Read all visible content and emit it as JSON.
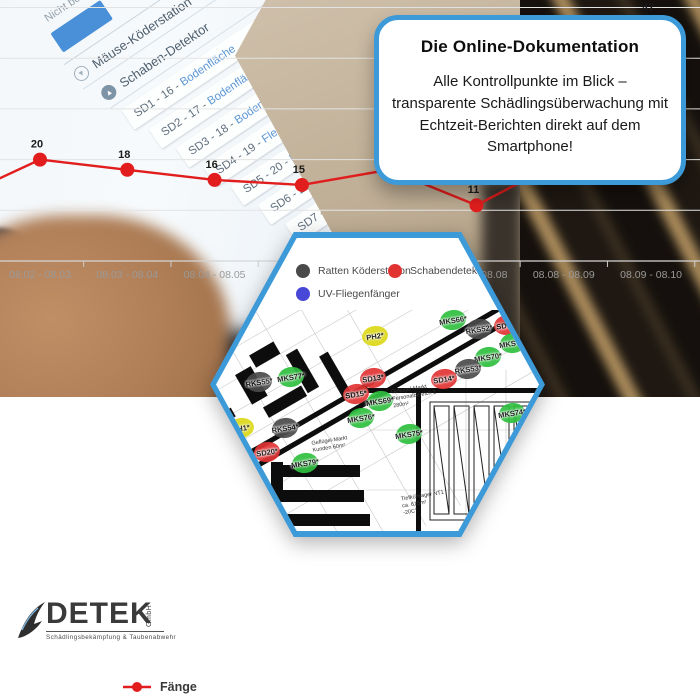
{
  "infobox": {
    "title": "Die Online-Dokumentation",
    "body": "Alle Kontrollpunkte im Blick – transparente Schädlingsüberwachung mit Echtzeit-Berichten direkt auf dem Smartphone!"
  },
  "phone": {
    "top_label": "Neu",
    "status_label": "Nicht besucht",
    "sections": [
      {
        "label": "Mäuse-Köderstation"
      },
      {
        "label": "Schaben-Detektor"
      }
    ],
    "items": [
      {
        "code": "SD1 - 16 - ",
        "location": "Bodenfläche"
      },
      {
        "code": "SD2 - 17 - ",
        "location": "Bodenfläche"
      },
      {
        "code": "SD3 - 18 - ",
        "location": "Bodenfläche"
      },
      {
        "code": "SD4 - 19 - ",
        "location": "Fleischerei"
      },
      {
        "code": "SD5 - 20 - ",
        "location": "Fleischerei"
      },
      {
        "code": "SD6 - 21 - ",
        "location": "Lager"
      },
      {
        "code": "SD7 - 22 - ",
        "location": "Lager"
      },
      {
        "code": "SD8 - 23 - ",
        "location": "Lager"
      }
    ]
  },
  "hexagon": {
    "legend": [
      {
        "label": "Mäuse Köderstation",
        "color": "#2fbf3f",
        "clipped": true,
        "x": -4,
        "y": 26
      },
      {
        "label": "Ratten Köderstation",
        "color": "#4a4a4a",
        "clipped": false,
        "x": 80,
        "y": 26
      },
      {
        "label": "Schabendetektor",
        "color": "#e23333",
        "clipped": false,
        "x": 172,
        "y": 26
      },
      {
        "label": "Pheromonfalle",
        "color": "#ddd818",
        "clipped": true,
        "x": -4,
        "y": 49
      },
      {
        "label": "UV-Fliegenfänger",
        "color": "#4747d8",
        "clipped": false,
        "x": 80,
        "y": 49
      }
    ],
    "markers": [
      {
        "id": "PH2*",
        "type": "ph",
        "x": 146,
        "y": 88
      },
      {
        "id": "MKS66*",
        "type": "mks",
        "x": 224,
        "y": 72
      },
      {
        "id": "RKS52*",
        "type": "rks",
        "x": 250,
        "y": 81
      },
      {
        "id": "SD12*",
        "type": "sd",
        "x": 278,
        "y": 77
      },
      {
        "id": "MKS71*",
        "type": "mks",
        "x": 284,
        "y": 95
      },
      {
        "id": "MKS70*",
        "type": "mks",
        "x": 259,
        "y": 109
      },
      {
        "id": "RKS53*",
        "type": "rks",
        "x": 239,
        "y": 121
      },
      {
        "id": "SD14*",
        "type": "sd",
        "x": 215,
        "y": 131
      },
      {
        "id": "SD13*",
        "type": "sd",
        "x": 144,
        "y": 130
      },
      {
        "id": "MKS77*",
        "type": "mks",
        "x": 62,
        "y": 129
      },
      {
        "id": "RKS55*",
        "type": "rks",
        "x": 30,
        "y": 134
      },
      {
        "id": "SD15*",
        "type": "sd",
        "x": 127,
        "y": 146
      },
      {
        "id": "MKS69*",
        "type": "mks",
        "x": 151,
        "y": 153
      },
      {
        "id": "MKS76*",
        "type": "mks",
        "x": 132,
        "y": 170
      },
      {
        "id": "RKS54*",
        "type": "rks",
        "x": 56,
        "y": 180
      },
      {
        "id": "PH1*",
        "type": "ph",
        "x": 12,
        "y": 180
      },
      {
        "id": "SD20*",
        "type": "sd",
        "x": 38,
        "y": 204
      },
      {
        "id": "MKS79*",
        "type": "mks",
        "x": 76,
        "y": 215
      },
      {
        "id": "SD17*",
        "type": "sd",
        "x": 16,
        "y": 235
      },
      {
        "id": "MKS78*",
        "type": "mks",
        "x": 20,
        "y": 246
      },
      {
        "id": "MKS75*",
        "type": "mks",
        "x": 180,
        "y": 186
      },
      {
        "id": "MKS74*",
        "type": "mks",
        "x": 283,
        "y": 165
      }
    ],
    "marker_colors": {
      "mks": "#2fbf3f",
      "rks": "#4a4a4a",
      "sd": "#e23333",
      "ph": "#ddd818"
    },
    "plan_labels": [
      {
        "text": "Geflügel-Markt\nPersonalbereich 1\n280m²",
        "x": 176,
        "y": 148
      },
      {
        "text": "Geflügel-Markt\nKunden 60m²",
        "x": 96,
        "y": 200
      },
      {
        "text": "Tiefkühllager NT1\nca. 615m²\n-20C°",
        "x": 186,
        "y": 255
      }
    ]
  },
  "logo": {
    "name": "DETEK",
    "suffix": "GmbH",
    "tagline": "Schädlingsbekämpfung & Taubenabwehr"
  },
  "chart_data": {
    "type": "line",
    "series_label": "Fänge",
    "categories": [
      "08.02 - 08.03",
      "08.03 - 08.04",
      "08.04 - 08.05",
      "08.05 - 08.06",
      "08.06 - 08.07",
      "08.07 - 08.08",
      "08.08 - 08.09",
      "08.09 - 08.10"
    ],
    "values": [
      20,
      18,
      16,
      15,
      18,
      11,
      20,
      47
    ],
    "edge_entry_value": 12,
    "line_color": "#e11d1d",
    "ylim": [
      0,
      52
    ],
    "grid_step": 10,
    "grid": true,
    "legend_position": "bottom"
  }
}
